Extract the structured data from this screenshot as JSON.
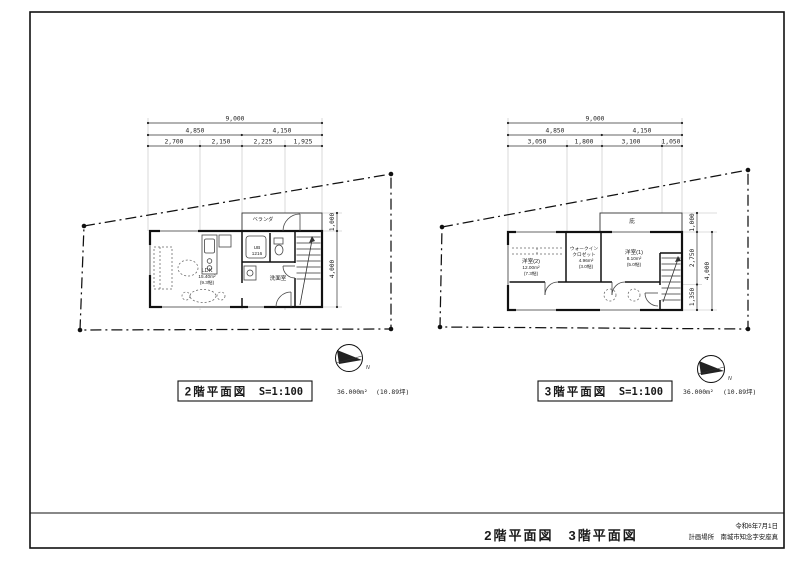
{
  "sheet": {
    "footer": {
      "combined_title": "2階平面図　3階平面図",
      "date": "令和6年7月1日",
      "location": "計画場所　南城市知念字安座真"
    }
  },
  "plan2": {
    "title": "2階平面図",
    "scale": "S=1:100",
    "area_m2": "36.000m²",
    "area_tsubo": "(10.89坪)",
    "dims": {
      "total": "9,000",
      "row2": [
        "4,850",
        "4,150"
      ],
      "row3": [
        "2,700",
        "2,150",
        "2,225",
        "1,925"
      ],
      "right": [
        "1,000",
        "4,000"
      ]
    },
    "labels": {
      "ldk_name": "LDK",
      "ldk_area": "15.40m²",
      "ldk_tatami": "(9.3帖)",
      "ub_name": "UB",
      "ub_size": "1216",
      "washroom": "洗面室",
      "balcony": "ベランダ",
      "compass": "N"
    }
  },
  "plan3": {
    "title": "3階平面図",
    "scale": "S=1:100",
    "area_m2": "36.000m²",
    "area_tsubo": "(10.89坪)",
    "dims": {
      "total": "9,000",
      "row2": [
        "4,850",
        "4,150"
      ],
      "row3": [
        "3,050",
        "1,800",
        "3,100",
        "1,050"
      ],
      "right": [
        "1,000",
        "2,750",
        "1,350",
        "4,000"
      ]
    },
    "labels": {
      "room2_name": "洋室(2)",
      "room2_area": "12.00m²",
      "room2_tatami": "(7.3帖)",
      "wic_line1": "ウォークイン",
      "wic_line2": "クロゼット",
      "wic_area": "4.96m²",
      "wic_tatami": "(3.0帖)",
      "room1_name": "洋室(1)",
      "room1_area": "8.10m²",
      "room1_tatami": "(5.0帖)",
      "eave": "庇",
      "compass": "N"
    }
  }
}
